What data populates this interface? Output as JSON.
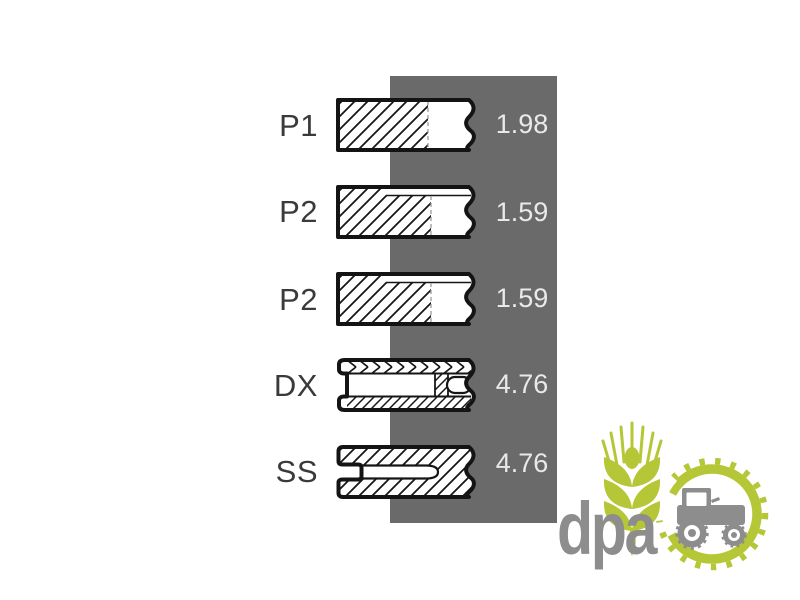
{
  "diagram": {
    "description": "piston ring set cross-sections",
    "rows": [
      {
        "label": "P1",
        "value": "1.98",
        "ring": "compression-ring"
      },
      {
        "label": "P2",
        "value": "1.59",
        "ring": "taper-face-ring"
      },
      {
        "label": "P2",
        "value": "1.59",
        "ring": "taper-face-ring"
      },
      {
        "label": "DX",
        "value": "4.76",
        "ring": "oil-control-ring"
      },
      {
        "label": "SS",
        "value": "4.76",
        "ring": "slotted-oil-ring"
      }
    ],
    "colors": {
      "band": "#6a6a6a",
      "value_text": "#e9e9e9",
      "label_text": "#3a3a3a",
      "outline": "#141414"
    }
  },
  "watermark": {
    "text": "dpa",
    "icons": [
      "wheat-icon",
      "gear-icon",
      "tractor-icon"
    ],
    "colors": {
      "green": "#b5c636",
      "gray": "#8d8d8d"
    }
  }
}
